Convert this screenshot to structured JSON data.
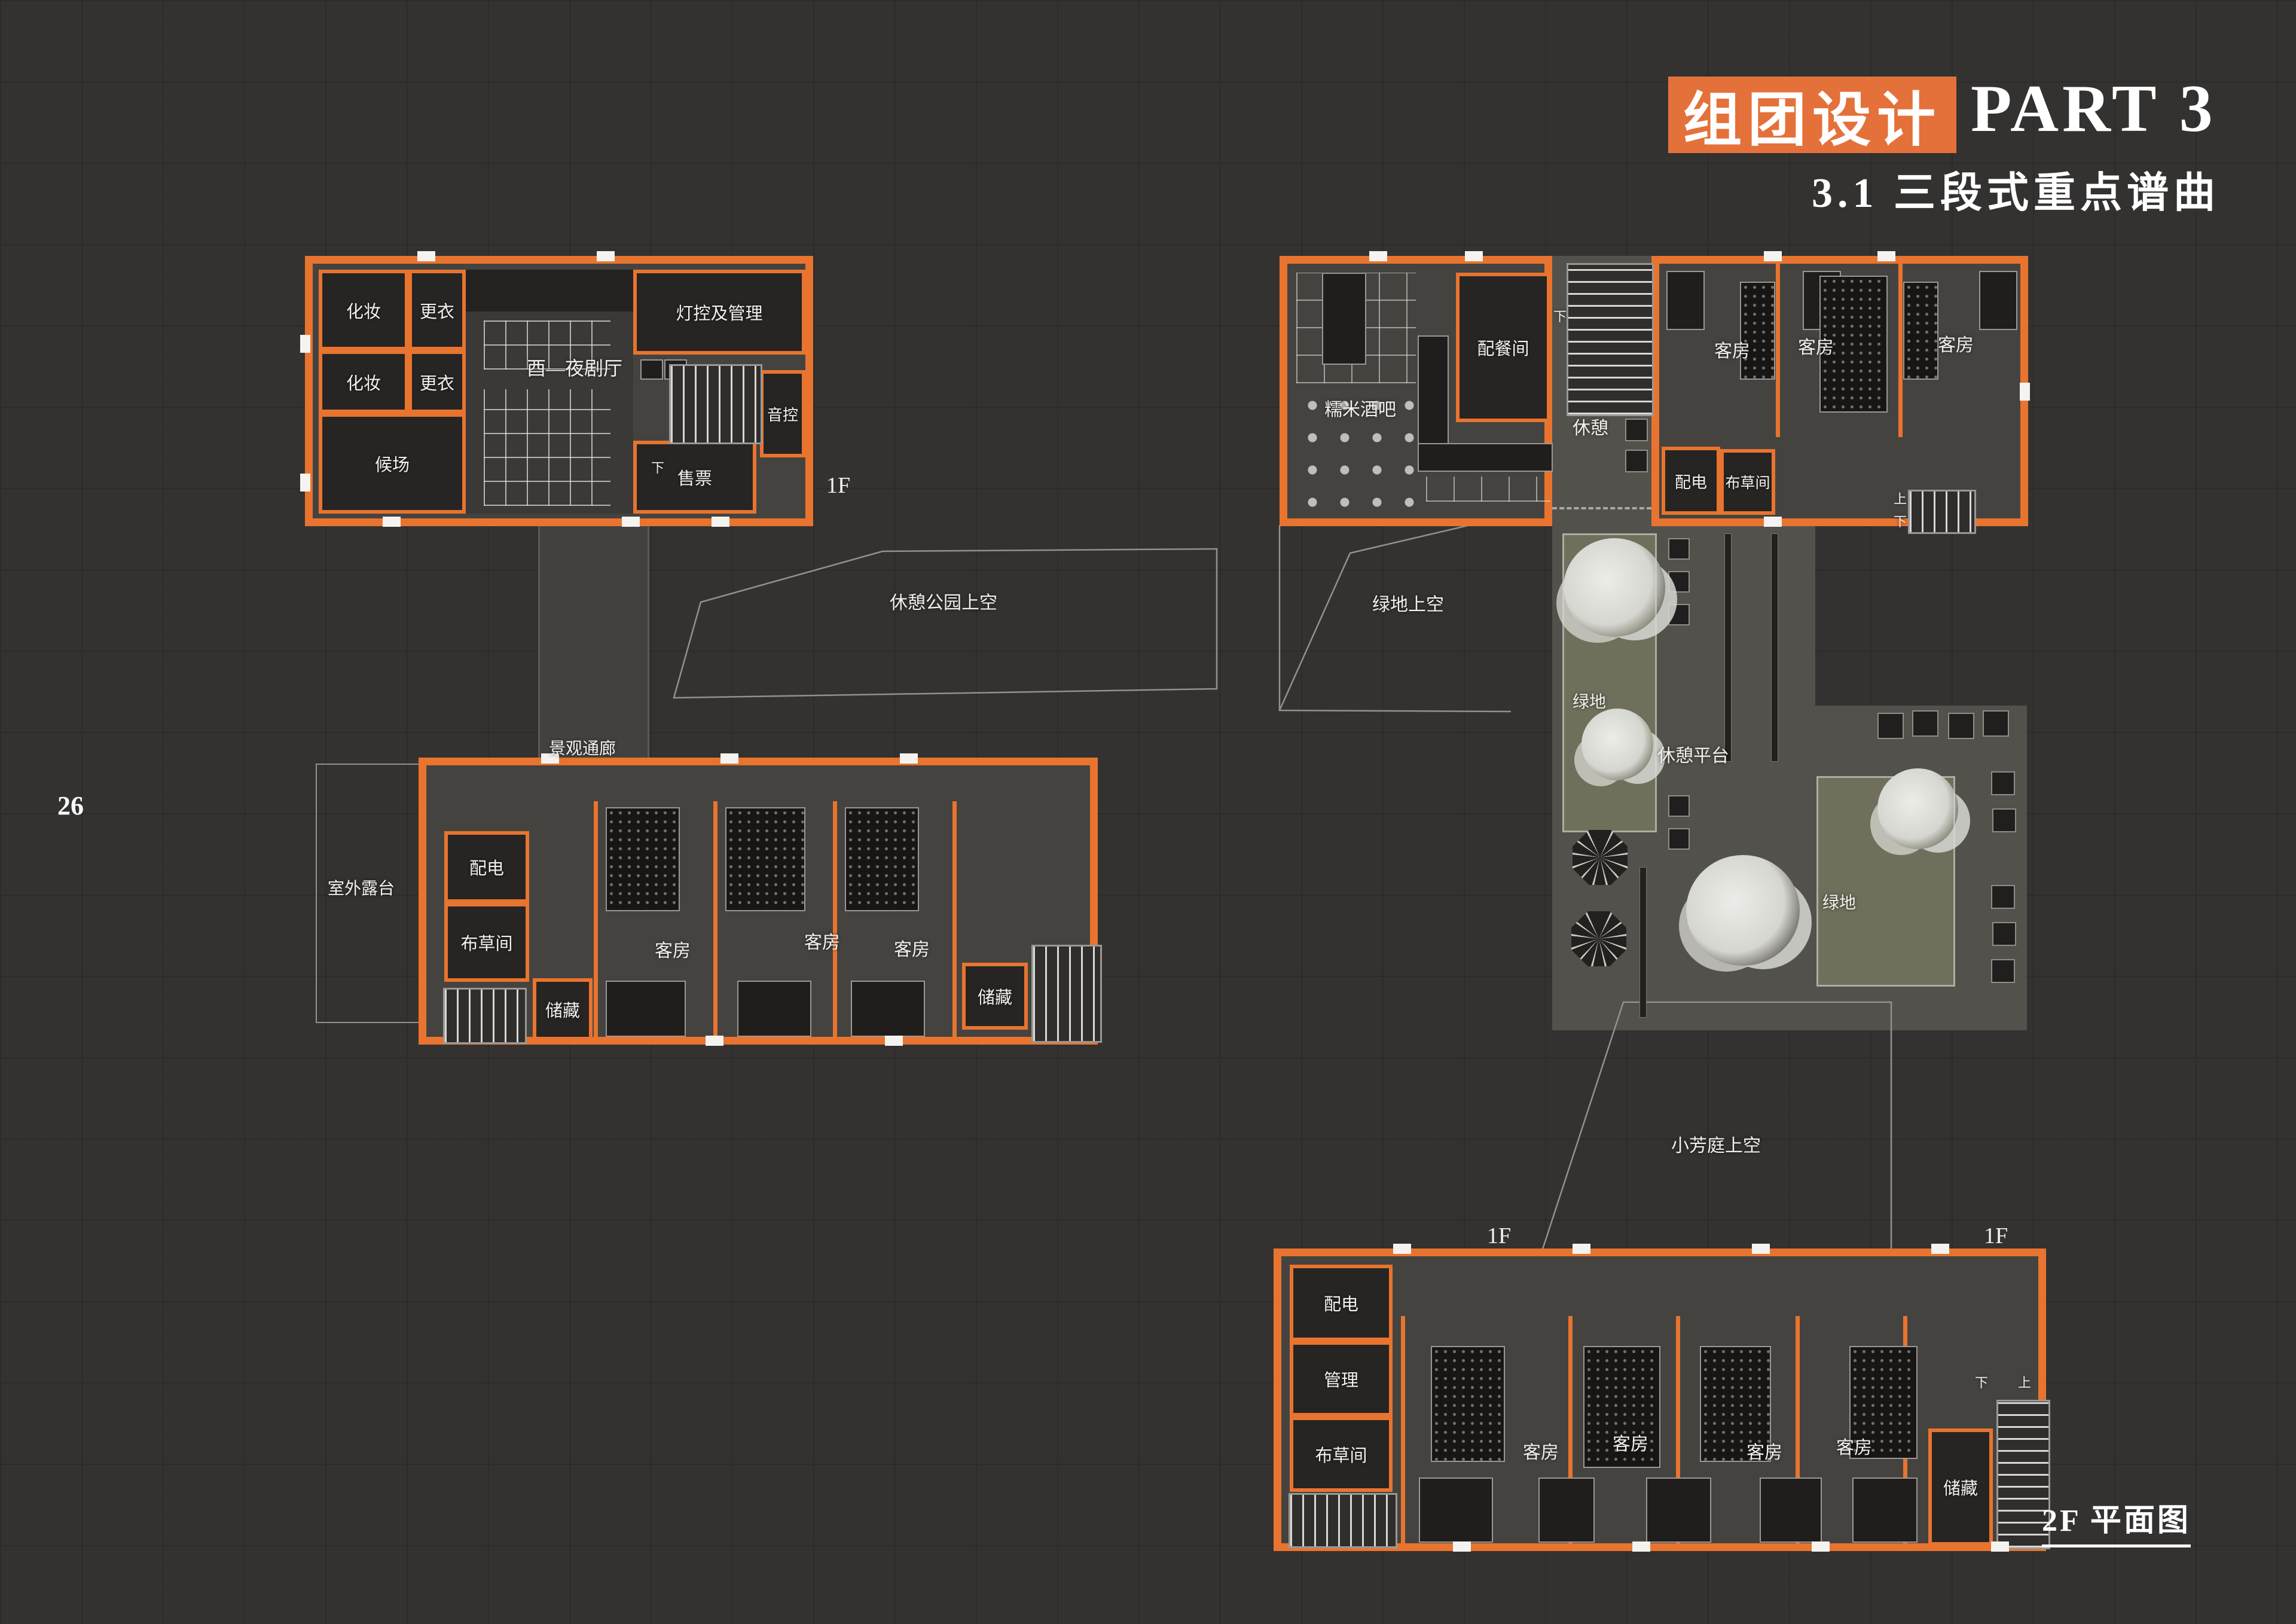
{
  "colors": {
    "background": "#343231",
    "accent_orange": "#e8742f",
    "title_orange": "#e4713a",
    "floor": "#45433f",
    "room_dark": "#262523",
    "plaza_gray": "#53514c",
    "green": "#6f6f5c",
    "tree": "#d9d9d4",
    "outline": "#93918c",
    "text": "#f2f1ed"
  },
  "header": {
    "badge": "组团设计",
    "part": "PART 3",
    "subtitle": "3.1 三段式重点谱曲"
  },
  "page_number": "26",
  "caption": "2F 平面图",
  "stairs": {
    "up": "上",
    "down": "下"
  },
  "theater": {
    "makeup_1": "化妆",
    "makeup_2": "化妆",
    "changing_1": "更衣",
    "changing_2": "更衣",
    "waiting": "候场",
    "hall": "酉—夜剧厅",
    "lighting": "灯控及管理",
    "sound": "音控",
    "ticket": "售票",
    "floor_tag": "1F"
  },
  "corridor": {
    "label": "景观通廊"
  },
  "voids": {
    "park": "休憩公园上空",
    "green": "绿地上空",
    "court": "小芳庭上空"
  },
  "west_hotel": {
    "terrace": "室外露台",
    "power": "配电",
    "linen": "布草间",
    "guests": [
      "客房",
      "客房",
      "客房"
    ],
    "storage_1": "储藏",
    "storage_2": "储藏"
  },
  "northeast": {
    "bar": "糯米酒吧",
    "pantry": "配餐间",
    "lounge": "休憩",
    "power": "配电",
    "linen": "布草间",
    "guests": [
      "客房",
      "客房",
      "客房"
    ]
  },
  "courtyard": {
    "green_1": "绿地",
    "green_2": "绿地",
    "platform": "休憩平台",
    "floor_tag_left": "1F",
    "floor_tag_right": "1F"
  },
  "south_hotel": {
    "power": "配电",
    "management": "管理",
    "linen": "布草间",
    "guests": [
      "客房",
      "客房",
      "客房",
      "客房"
    ],
    "storage": "储藏"
  }
}
